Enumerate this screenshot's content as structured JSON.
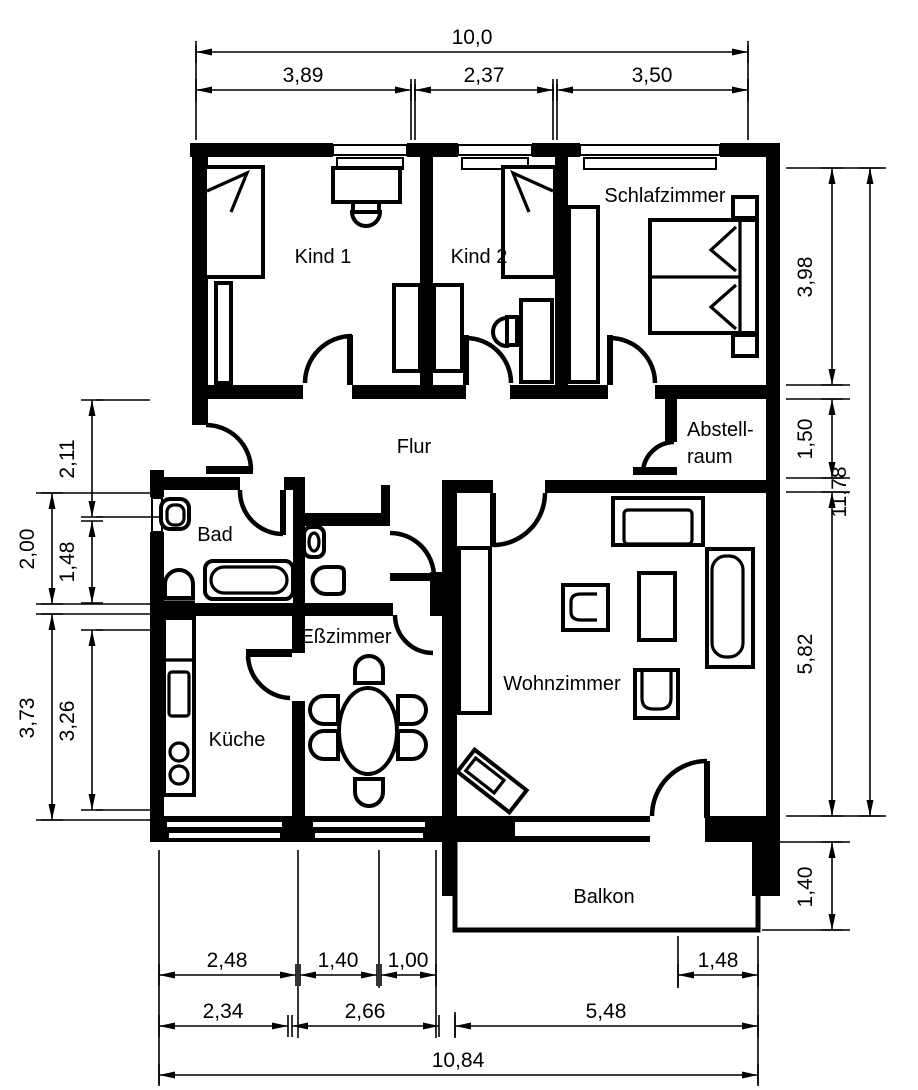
{
  "colors": {
    "ink": "#000000",
    "paper": "#ffffff"
  },
  "rooms": [
    {
      "id": "kind1",
      "label": "Kind 1",
      "x": 323,
      "y": 263,
      "anchor": "middle"
    },
    {
      "id": "kind2",
      "label": "Kind 2",
      "x": 479,
      "y": 263,
      "anchor": "middle"
    },
    {
      "id": "schlafzimmer",
      "label": "Schlafzimmer",
      "x": 665,
      "y": 202,
      "anchor": "middle"
    },
    {
      "id": "flur",
      "label": "Flur",
      "x": 414,
      "y": 453,
      "anchor": "middle"
    },
    {
      "id": "abstellraum",
      "label": "Abstell-",
      "label2": "raum",
      "x": 687,
      "y": 436,
      "y2": 463,
      "anchor": "start"
    },
    {
      "id": "bad",
      "label": "Bad",
      "x": 215,
      "y": 541,
      "anchor": "middle"
    },
    {
      "id": "esszimmer",
      "label": "Eßzimmer",
      "x": 346,
      "y": 643,
      "anchor": "middle"
    },
    {
      "id": "kueche",
      "label": "Küche",
      "x": 237,
      "y": 746,
      "anchor": "middle"
    },
    {
      "id": "wohnzimmer",
      "label": "Wohnzimmer",
      "x": 562,
      "y": 690,
      "anchor": "middle"
    },
    {
      "id": "balkon",
      "label": "Balkon",
      "x": 604,
      "y": 903,
      "anchor": "middle"
    }
  ],
  "dimensions": [
    {
      "id": "width-total",
      "value": "10,0",
      "orient": "h",
      "a": 196,
      "b": 748,
      "pos": 52,
      "lx": 472,
      "ly": 44
    },
    {
      "id": "width-kind1",
      "value": "3,89",
      "orient": "h",
      "a": 196,
      "b": 411,
      "pos": 90,
      "lx": 303,
      "ly": 82
    },
    {
      "id": "width-kind2",
      "value": "2,37",
      "orient": "h",
      "a": 415,
      "b": 553,
      "pos": 90,
      "lx": 484,
      "ly": 82
    },
    {
      "id": "width-schlaf",
      "value": "3,50",
      "orient": "h",
      "a": 557,
      "b": 748,
      "pos": 90,
      "lx": 652,
      "ly": 82
    },
    {
      "id": "height-schlaf",
      "value": "3,98",
      "orient": "v",
      "a": 168,
      "b": 385,
      "pos": 832,
      "lx": 812,
      "ly": 277
    },
    {
      "id": "height-flur",
      "value": "1,50",
      "orient": "v",
      "a": 399,
      "b": 478,
      "pos": 832,
      "lx": 812,
      "ly": 439
    },
    {
      "id": "height-wohnz",
      "value": "5,82",
      "orient": "v",
      "a": 492,
      "b": 816,
      "pos": 832,
      "lx": 812,
      "ly": 654
    },
    {
      "id": "height-balkon",
      "value": "1,40",
      "orient": "v",
      "a": 842,
      "b": 930,
      "pos": 832,
      "lx": 812,
      "ly": 887
    },
    {
      "id": "height-total",
      "value": "11,78",
      "orient": "v",
      "a": 168,
      "b": 816,
      "pos": 870,
      "lx": 846,
      "ly": 492
    },
    {
      "id": "left-flur",
      "value": "2,11",
      "orient": "v",
      "a": 400,
      "b": 517,
      "pos": 92,
      "lx": 74,
      "ly": 459
    },
    {
      "id": "left-bad",
      "value": "1,48",
      "orient": "v",
      "a": 521,
      "b": 603,
      "pos": 92,
      "lx": 74,
      "ly": 562
    },
    {
      "id": "left-kueche",
      "value": "3,26",
      "orient": "v",
      "a": 630,
      "b": 810,
      "pos": 92,
      "lx": 74,
      "ly": 721
    },
    {
      "id": "left-bad-outer",
      "value": "2,00",
      "orient": "v",
      "a": 493,
      "b": 604,
      "pos": 52,
      "lx": 34,
      "ly": 549
    },
    {
      "id": "left-kueche-outer",
      "value": "3,73",
      "orient": "v",
      "a": 614,
      "b": 820,
      "pos": 52,
      "lx": 34,
      "ly": 718
    },
    {
      "id": "bottom-a1",
      "value": "2,48",
      "orient": "h",
      "a": 159,
      "b": 296,
      "pos": 975,
      "lx": 227,
      "ly": 967
    },
    {
      "id": "bottom-a2",
      "value": "1,40",
      "orient": "h",
      "a": 300,
      "b": 377,
      "pos": 975,
      "lx": 338,
      "ly": 967
    },
    {
      "id": "bottom-a3",
      "value": "1,00",
      "orient": "h",
      "a": 381,
      "b": 436,
      "pos": 975,
      "lx": 408,
      "ly": 967
    },
    {
      "id": "bottom-a4",
      "value": "1,48",
      "orient": "h",
      "a": 678,
      "b": 758,
      "pos": 975,
      "lx": 718,
      "ly": 967
    },
    {
      "id": "bottom-b1",
      "value": "2,34",
      "orient": "h",
      "a": 159,
      "b": 288,
      "pos": 1026,
      "lx": 223,
      "ly": 1018
    },
    {
      "id": "bottom-b2",
      "value": "2,66",
      "orient": "h",
      "a": 292,
      "b": 439,
      "pos": 1026,
      "lx": 365,
      "ly": 1018
    },
    {
      "id": "bottom-b3",
      "value": "5,48",
      "orient": "h",
      "a": 455,
      "b": 758,
      "pos": 1026,
      "lx": 606,
      "ly": 1018
    },
    {
      "id": "bottom-total",
      "value": "10,84",
      "orient": "h",
      "a": 159,
      "b": 758,
      "pos": 1075,
      "lx": 458,
      "ly": 1067
    }
  ],
  "extension_lines": [
    [
      196,
      46,
      196,
      140
    ],
    [
      411,
      84,
      411,
      140
    ],
    [
      415,
      84,
      415,
      140
    ],
    [
      553,
      84,
      553,
      140
    ],
    [
      557,
      84,
      557,
      140
    ],
    [
      748,
      46,
      748,
      140
    ],
    [
      786,
      168,
      886,
      168
    ],
    [
      786,
      385,
      850,
      385
    ],
    [
      786,
      399,
      850,
      399
    ],
    [
      786,
      478,
      850,
      478
    ],
    [
      786,
      492,
      850,
      492
    ],
    [
      786,
      816,
      886,
      816
    ],
    [
      772,
      842,
      850,
      842
    ],
    [
      762,
      930,
      850,
      930
    ],
    [
      96,
      400,
      150,
      400
    ],
    [
      36,
      493,
      160,
      493
    ],
    [
      96,
      517,
      162,
      517
    ],
    [
      36,
      604,
      164,
      604
    ],
    [
      36,
      614,
      164,
      614
    ],
    [
      96,
      630,
      150,
      630
    ],
    [
      96,
      810,
      160,
      810
    ],
    [
      36,
      820,
      164,
      820
    ],
    [
      159,
      850,
      159,
      1084
    ],
    [
      298,
      850,
      298,
      1038
    ],
    [
      379,
      850,
      379,
      988
    ],
    [
      436,
      850,
      436,
      1038
    ],
    [
      455,
      1012,
      455,
      1038
    ],
    [
      678,
      936,
      678,
      988
    ],
    [
      758,
      936,
      758,
      1084
    ]
  ]
}
